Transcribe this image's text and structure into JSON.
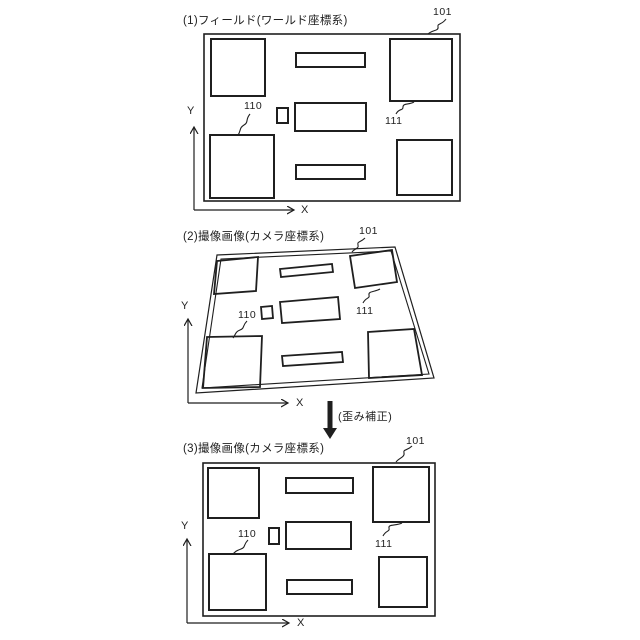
{
  "colors": {
    "line": "#1f1f1f",
    "background": "#ffffff"
  },
  "panels": {
    "p1": {
      "title": "(1)フィールド(ワールド座標系)",
      "ref_101": "101",
      "ref_110": "110",
      "ref_111": "111",
      "axis_x": "X",
      "axis_y": "Y"
    },
    "p2": {
      "title": "(2)撮像画像(カメラ座標系)",
      "ref_101": "101",
      "ref_110": "110",
      "ref_111": "111",
      "axis_x": "X",
      "axis_y": "Y"
    },
    "p3": {
      "title": "(3)撮像画像(カメラ座標系)",
      "ref_101": "101",
      "ref_110": "110",
      "ref_111": "111",
      "axis_x": "X",
      "axis_y": "Y"
    }
  },
  "transform": {
    "label": "(歪み補正)"
  }
}
